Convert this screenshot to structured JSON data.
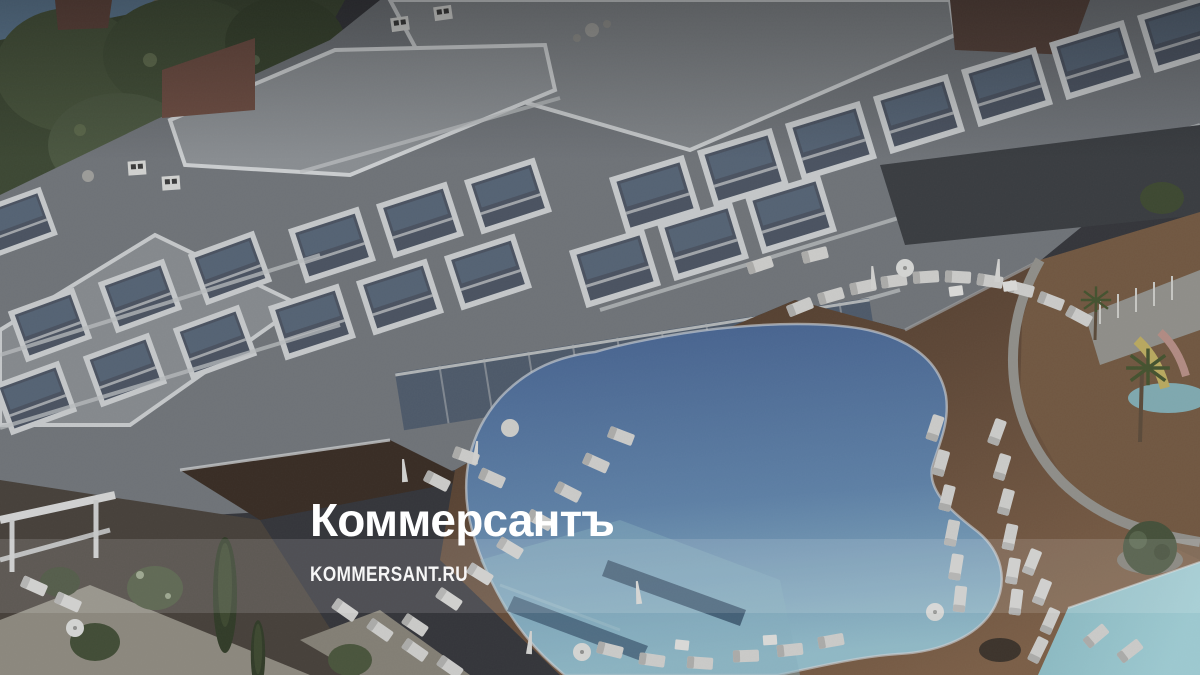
{
  "page": {
    "type": "news-article-lead-photo",
    "width": 1200,
    "height": 675
  },
  "photo": {
    "alt": "Darkened aerial 3D rendering of a modern white hotel complex with a kidney-shaped swimming pool, wooden sun deck, rows of white loungers, parasols, a water slide and green trees"
  },
  "watermark": {
    "logo_text": "Коммерсантъ",
    "site_text": "KOMMERSANT.RU"
  },
  "colors": {
    "watermark_text": "#ffffff",
    "backdrop": "#34353a",
    "sea": "#5d7891",
    "sand": "#7e7a6a",
    "trees_dark": "#3c4733",
    "trees_mid": "#46523b",
    "building_base": "#6e7277",
    "roof_gray": "#7e8286",
    "parapet_white": "#c3c6c8",
    "glass_dark": "#4a5260",
    "facade_dark_wall": "#393c40",
    "brown_wall": "#6b4c42",
    "podium_brown": "#382c24",
    "deck_dark": "#473627",
    "deck_mid": "#5c4636",
    "deck_light": "#7a5e47",
    "pool_deep": "#45608c",
    "pool_mid": "#5d7fa4",
    "pool_shallow": "#8fb7c4",
    "pool_corner": "#9cc8cf",
    "pool_step_dark": "#39536b",
    "path_light": "#8b877d",
    "lounger_white": "#c9c9c7",
    "slide_yellow": "#b7a75f",
    "slide_pink": "#b08a82",
    "band_overlay": "rgba(255,255,255,0.13)"
  }
}
